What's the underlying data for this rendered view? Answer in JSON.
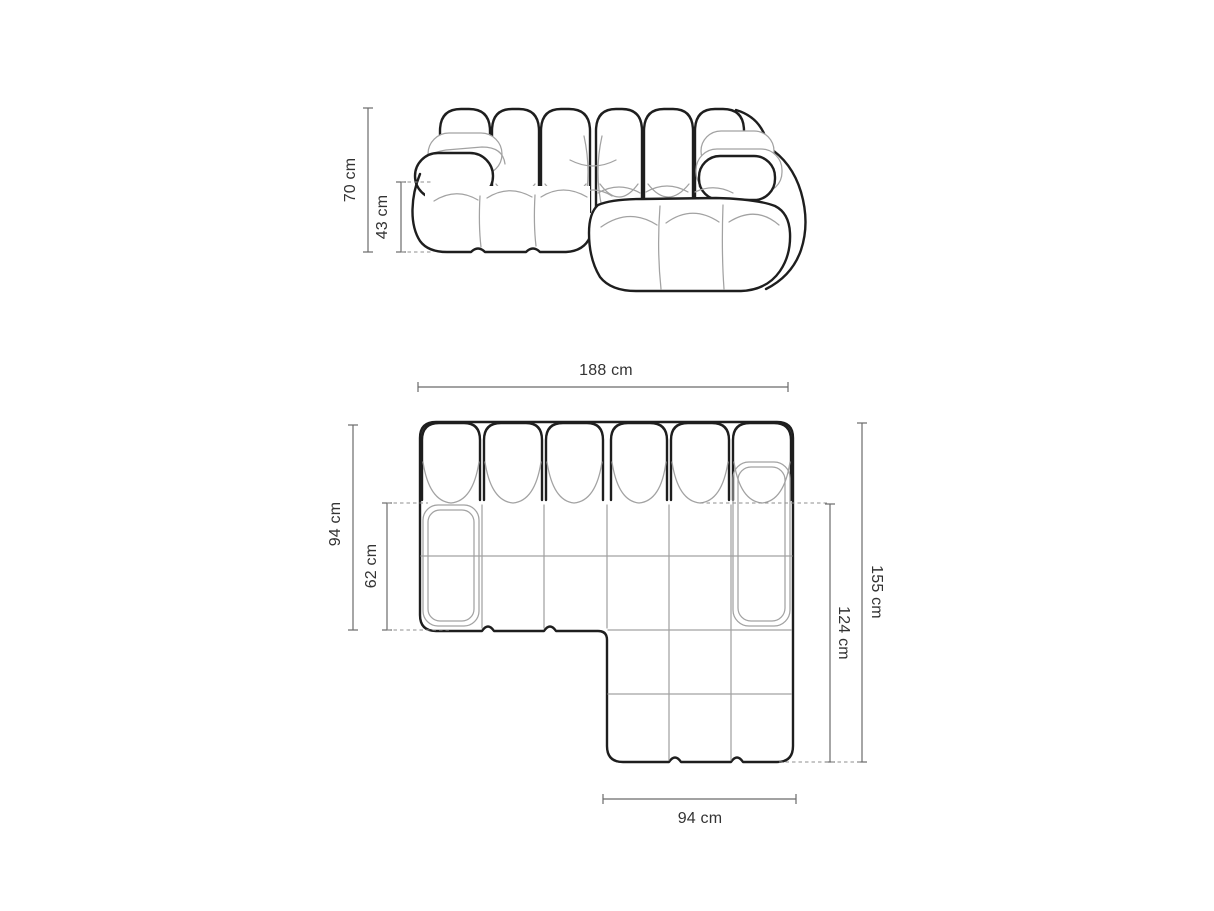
{
  "canvas": {
    "width": 1214,
    "height": 911,
    "background": "#ffffff"
  },
  "colors": {
    "outline_bold": "#1e1e1e",
    "outline_thin": "#a2a2a2",
    "dim_line": "#6b6b6b",
    "dash_line": "#8f8f8f",
    "text": "#333333"
  },
  "units": "cm",
  "dims": {
    "front_height": {
      "label": "70 cm",
      "value_cm": 70
    },
    "front_seat_height": {
      "label": "43 cm",
      "value_cm": 43
    },
    "width_total": {
      "label": "188 cm",
      "value_cm": 188
    },
    "depth_total": {
      "label": "94 cm",
      "value_cm": 94
    },
    "depth_seat": {
      "label": "62 cm",
      "value_cm": 62
    },
    "length_right": {
      "label": "155 cm",
      "value_cm": 155
    },
    "chaise_length": {
      "label": "124 cm",
      "value_cm": 124
    },
    "chaise_width": {
      "label": "94 cm",
      "value_cm": 94
    }
  }
}
